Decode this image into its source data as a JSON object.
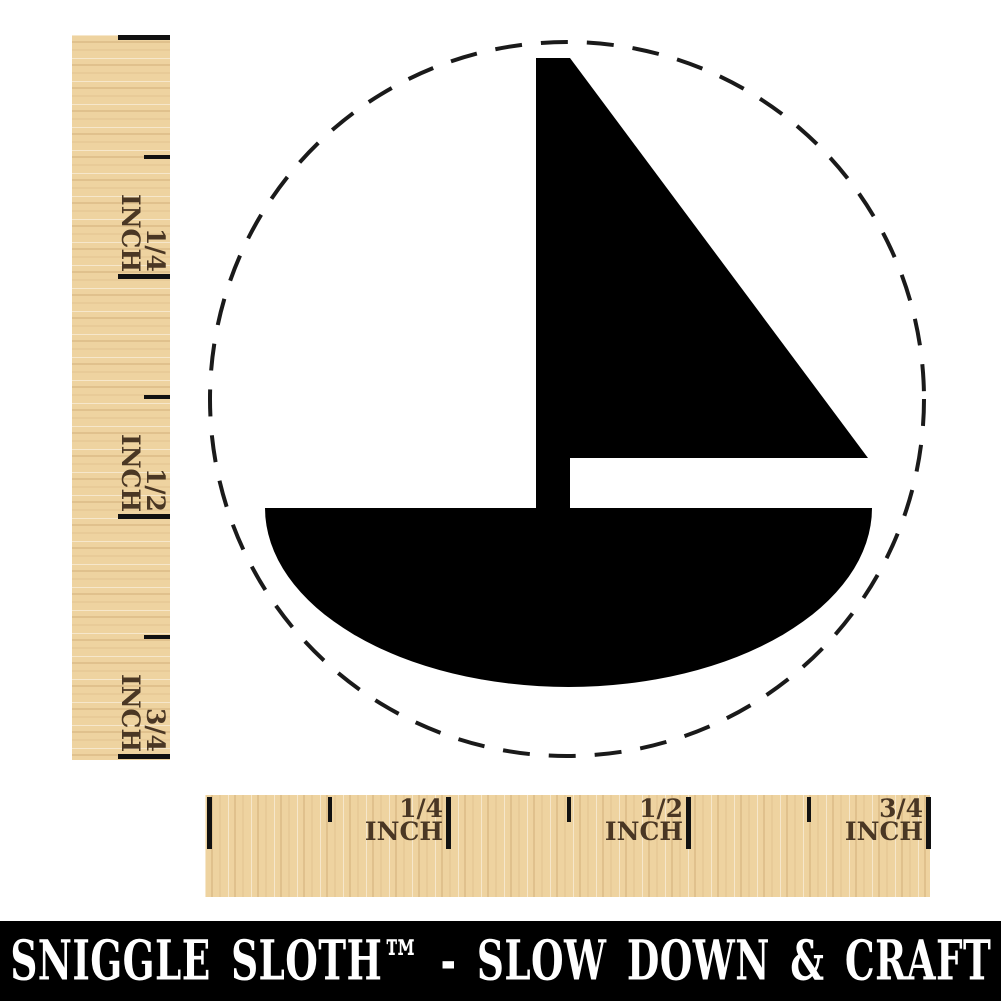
{
  "image": {
    "kind": "rubber-stamp-size-mockup",
    "background_color": "#ffffff"
  },
  "stamp": {
    "design": "sail-boat",
    "ink_color": "#000000",
    "outline": {
      "shape": "dashed-circle",
      "color": "#1a1a1a"
    }
  },
  "rulers": {
    "wood_color": "#eed3a0",
    "tick_color": "#111111",
    "label_color": "#4a3724",
    "vertical": {
      "labels": [
        {
          "fraction": "1/4",
          "unit": "INCH"
        },
        {
          "fraction": "1/2",
          "unit": "INCH"
        },
        {
          "fraction": "3/4",
          "unit": "INCH"
        }
      ]
    },
    "horizontal": {
      "labels": [
        {
          "fraction": "1/4",
          "unit": "INCH"
        },
        {
          "fraction": "1/2",
          "unit": "INCH"
        },
        {
          "fraction": "3/4",
          "unit": "INCH"
        }
      ]
    }
  },
  "footer": {
    "background_color": "#000000",
    "text_color": "#ffffff",
    "text": "SNIGGLE SLOTH™ - SLOW DOWN & CRAFT"
  }
}
